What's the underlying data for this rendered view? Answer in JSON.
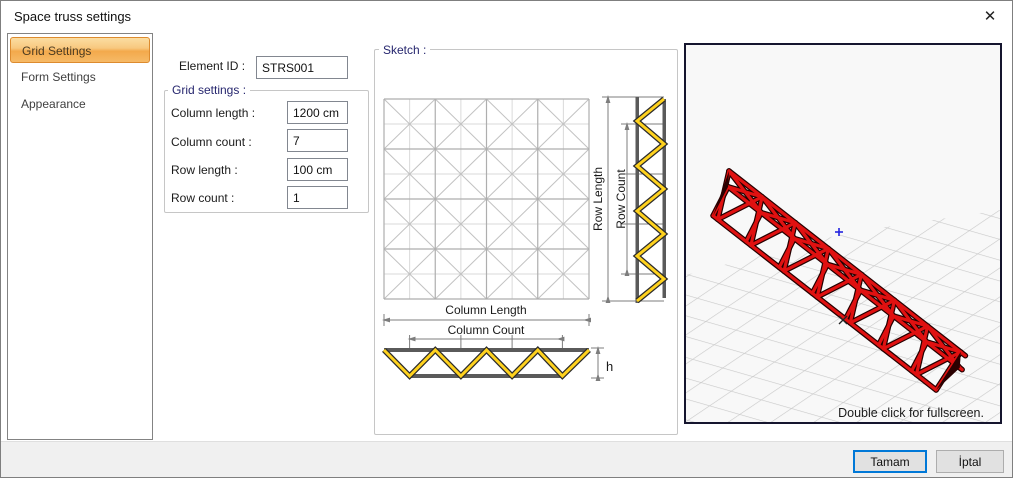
{
  "window": {
    "title": "Space truss settings",
    "close_icon": "✕"
  },
  "sidebar": {
    "items": [
      {
        "label": "Grid Settings",
        "selected": true
      },
      {
        "label": "Form Settings",
        "selected": false
      },
      {
        "label": "Appearance",
        "selected": false
      }
    ]
  },
  "form": {
    "element_id_label": "Element ID :",
    "element_id_value": "STRS001",
    "group_title": "Grid settings :",
    "fields": [
      {
        "label": "Column length :",
        "value": "1200 cm"
      },
      {
        "label": "Column count :",
        "value": "7"
      },
      {
        "label": "Row length :",
        "value": "100 cm"
      },
      {
        "label": "Row count :",
        "value": "1"
      }
    ]
  },
  "sketch": {
    "group_title": "Sketch :",
    "labels": {
      "row_length": "Row Length",
      "row_count": "Row Count",
      "column_length": "Column Length",
      "column_count": "Column Count",
      "height": "h"
    },
    "colors": {
      "truss_yellow": "#ffd21e",
      "chord_gray": "#5a5a5a",
      "dim_gray": "#7d7d7d"
    }
  },
  "preview": {
    "hint": "Double click for fullscreen.",
    "colors": {
      "truss_red": "#e01111",
      "border": "#15152e",
      "grid": "#c9c9c9",
      "marker_blue": "#2424e0"
    }
  },
  "footer": {
    "ok_label": "Tamam",
    "cancel_label": "İptal"
  }
}
